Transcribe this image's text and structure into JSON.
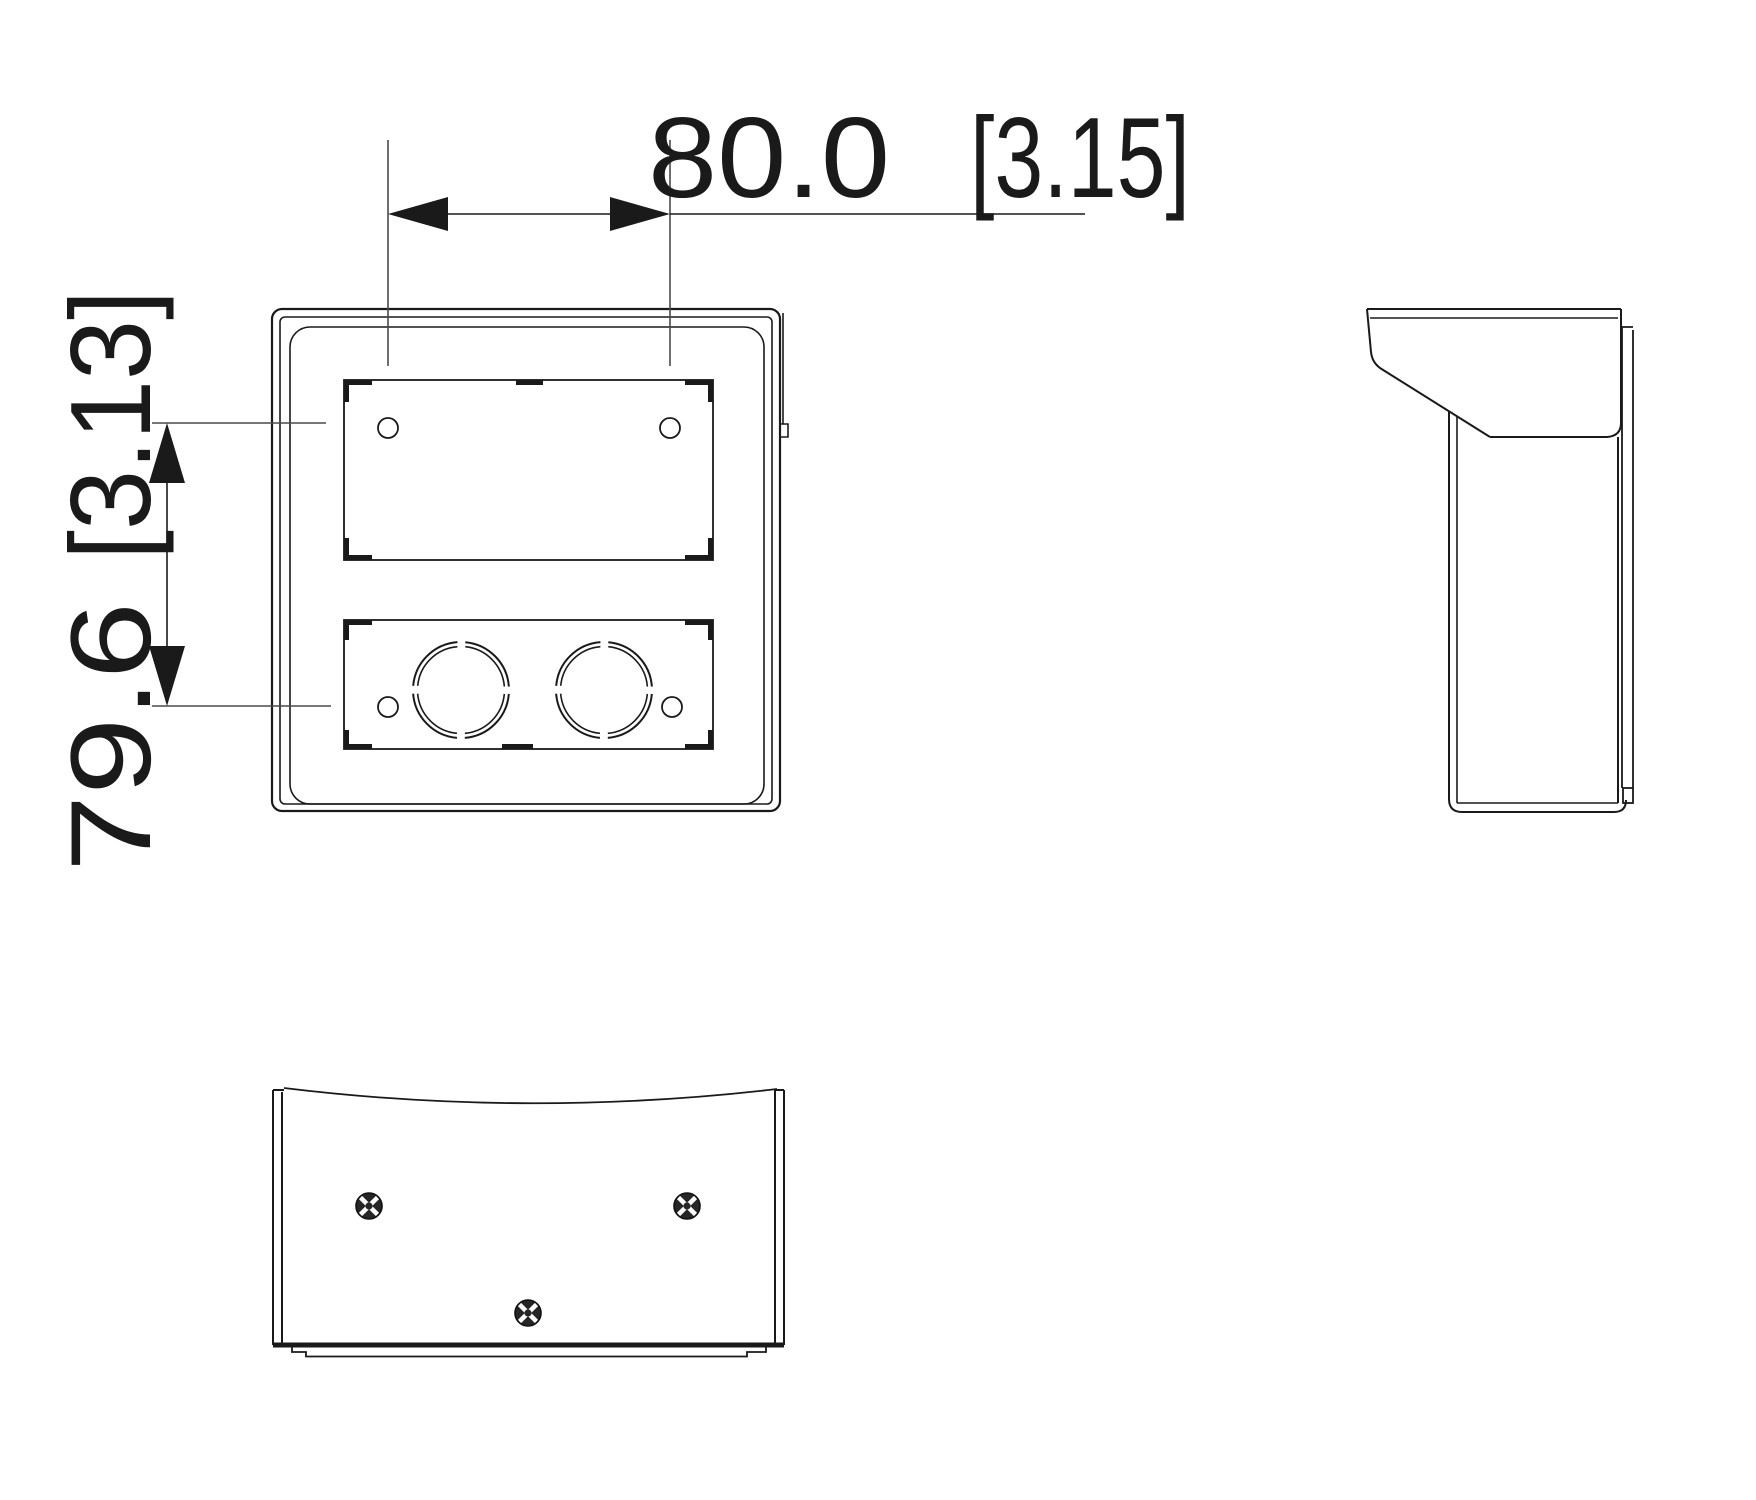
{
  "drawing": {
    "type": "technical-dimension-drawing",
    "dimensions": {
      "horizontal": {
        "mm": "80.0",
        "inches": "[3.15]"
      },
      "vertical": {
        "mm": "79.6",
        "inches": "[3.13]"
      }
    },
    "colors": {
      "line": "#1a1a1a",
      "extension_line": "#4a4a4a",
      "background": "#ffffff"
    },
    "icons": {
      "screws": "phillips-screw-icon",
      "screw_count_bottom_view": "3"
    }
  }
}
